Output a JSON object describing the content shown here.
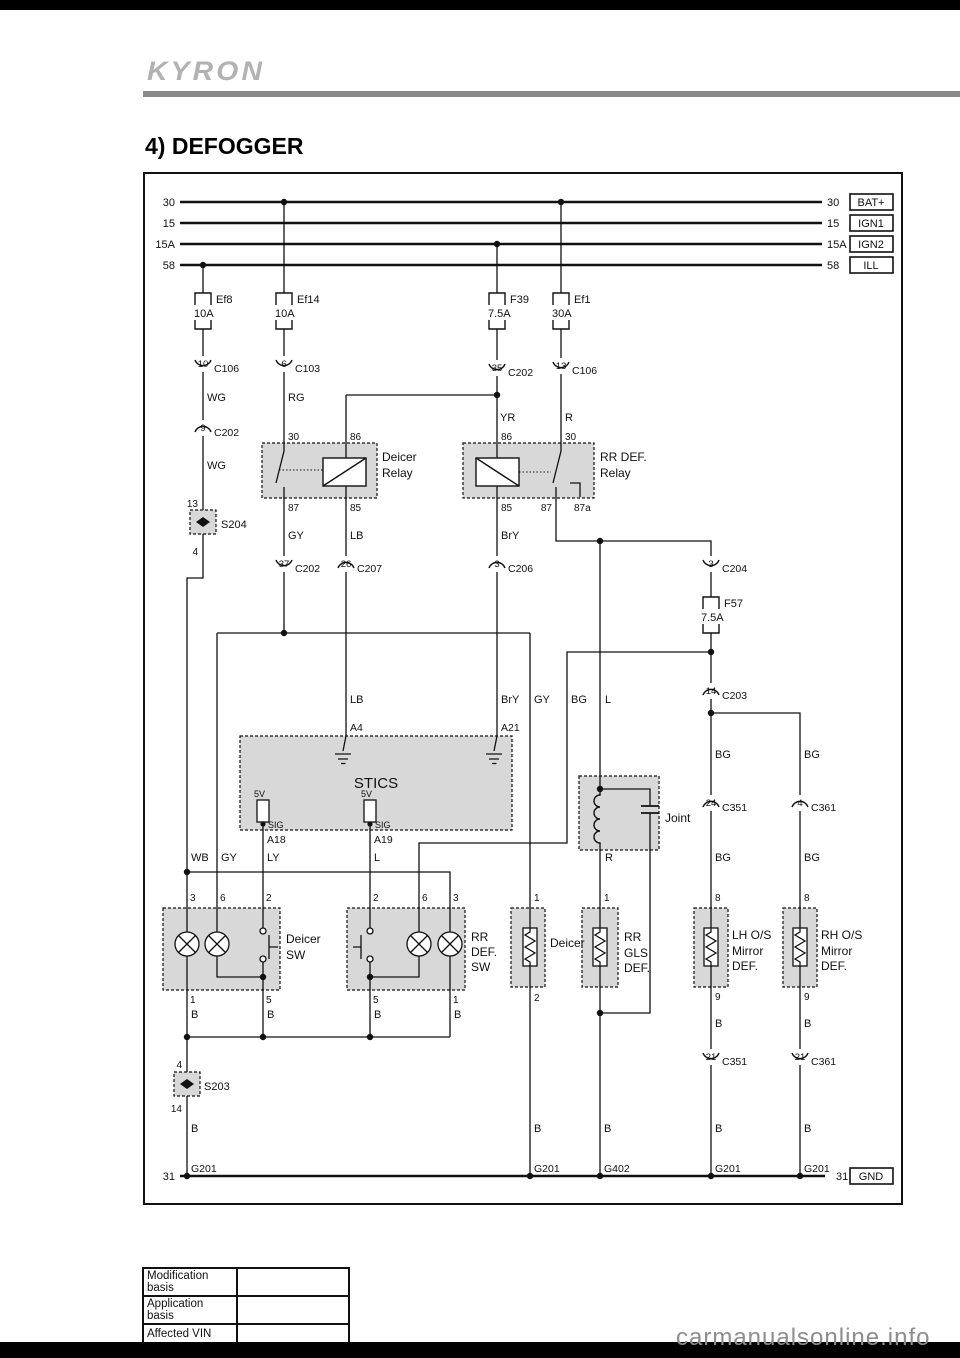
{
  "page": {
    "brand": "KYRON",
    "title": "4) DEFOGGER",
    "watermark": "carmanualsonline.info"
  },
  "footer_table": {
    "rows": [
      {
        "label": "Modification basis",
        "value": ""
      },
      {
        "label": "Application basis",
        "value": ""
      },
      {
        "label": "Affected VIN",
        "value": ""
      }
    ]
  },
  "diagram": {
    "texts": [
      {
        "n": "bus-30-left",
        "x": 175,
        "y": 206,
        "t": "30",
        "a": "end",
        "s": 11
      },
      {
        "n": "bus-15-left",
        "x": 175,
        "y": 227,
        "t": "15",
        "a": "end",
        "s": 11
      },
      {
        "n": "bus-15a-left",
        "x": 175,
        "y": 248,
        "t": "15A",
        "a": "end",
        "s": 11
      },
      {
        "n": "bus-58-left",
        "x": 175,
        "y": 269,
        "t": "58",
        "a": "end",
        "s": 11
      },
      {
        "n": "bus-30-right",
        "x": 827,
        "y": 206,
        "t": "30",
        "s": 11
      },
      {
        "n": "bus-15-right",
        "x": 827,
        "y": 227,
        "t": "15",
        "s": 11
      },
      {
        "n": "bus-15a-right",
        "x": 827,
        "y": 248,
        "t": "15A",
        "s": 11
      },
      {
        "n": "bus-58-right",
        "x": 827,
        "y": 269,
        "t": "58",
        "s": 11
      },
      {
        "n": "terminal-bat",
        "x": 871,
        "y": 206,
        "t": "BAT+",
        "a": "middle",
        "s": 11
      },
      {
        "n": "terminal-ign1",
        "x": 871,
        "y": 227,
        "t": "IGN1",
        "a": "middle",
        "s": 11
      },
      {
        "n": "terminal-ign2",
        "x": 871,
        "y": 248,
        "t": "IGN2",
        "a": "middle",
        "s": 11
      },
      {
        "n": "terminal-ill",
        "x": 871,
        "y": 269,
        "t": "ILL",
        "a": "middle",
        "s": 11
      },
      {
        "n": "bus-31-left",
        "x": 175,
        "y": 1180,
        "t": "31",
        "a": "end",
        "s": 11
      },
      {
        "n": "bus-31-right",
        "x": 836,
        "y": 1180,
        "t": "31",
        "s": 11
      },
      {
        "n": "terminal-gnd",
        "x": 871,
        "y": 1180,
        "t": "GND",
        "a": "middle",
        "s": 11
      },
      {
        "n": "fuse-ef8-name",
        "x": 216,
        "y": 303,
        "t": "Ef8",
        "s": 11
      },
      {
        "n": "fuse-ef8-amp",
        "x": 194,
        "y": 317,
        "t": "10A",
        "s": 11
      },
      {
        "n": "fuse-ef14-name",
        "x": 297,
        "y": 303,
        "t": "Ef14",
        "s": 11
      },
      {
        "n": "fuse-ef14-amp",
        "x": 275,
        "y": 317,
        "t": "10A",
        "s": 11
      },
      {
        "n": "fuse-f39-name",
        "x": 510,
        "y": 303,
        "t": "F39",
        "s": 11
      },
      {
        "n": "fuse-f39-amp",
        "x": 488,
        "y": 317,
        "t": "7.5A",
        "s": 11
      },
      {
        "n": "fuse-ef1-name",
        "x": 574,
        "y": 303,
        "t": "Ef1",
        "s": 11
      },
      {
        "n": "fuse-ef1-amp",
        "x": 552,
        "y": 317,
        "t": "30A",
        "s": 11
      },
      {
        "n": "fuse-f57-name",
        "x": 724,
        "y": 607,
        "t": "F57",
        "s": 11
      },
      {
        "n": "fuse-f57-amp",
        "x": 701,
        "y": 621,
        "t": "7.5A",
        "s": 11
      },
      {
        "n": "conn-c106-pin10",
        "x": 203,
        "y": 367,
        "t": "10",
        "a": "middle",
        "s": 9.5
      },
      {
        "n": "conn-c106-name",
        "x": 214,
        "y": 372,
        "t": "C106",
        "s": 10.5
      },
      {
        "n": "conn-c103-pin6",
        "x": 284,
        "y": 367,
        "t": "6",
        "a": "middle",
        "s": 9.5
      },
      {
        "n": "conn-c103-name",
        "x": 295,
        "y": 372,
        "t": "C103",
        "s": 10.5
      },
      {
        "n": "conn-c202-pin35",
        "x": 497,
        "y": 371,
        "t": "35",
        "a": "middle",
        "s": 9.5
      },
      {
        "n": "conn-c202-name-top",
        "x": 508,
        "y": 376,
        "t": "C202",
        "s": 10.5
      },
      {
        "n": "conn-c106-pin13",
        "x": 561,
        "y": 369,
        "t": "13",
        "a": "middle",
        "s": 9.5
      },
      {
        "n": "conn-c106b-name",
        "x": 572,
        "y": 374,
        "t": "C106",
        "s": 10.5
      },
      {
        "n": "conn-c202-pin9",
        "x": 203,
        "y": 431,
        "t": "9",
        "a": "middle",
        "s": 9.5
      },
      {
        "n": "conn-c202-name-mid",
        "x": 214,
        "y": 436,
        "t": "C202",
        "s": 10.5
      },
      {
        "n": "conn-c202-pin37",
        "x": 284,
        "y": 567,
        "t": "37",
        "a": "middle",
        "s": 9.5
      },
      {
        "n": "conn-c202-name-low",
        "x": 295,
        "y": 572,
        "t": "C202",
        "s": 10.5
      },
      {
        "n": "conn-c207-pin26",
        "x": 346,
        "y": 567,
        "t": "26",
        "a": "middle",
        "s": 9.5
      },
      {
        "n": "conn-c207-name",
        "x": 357,
        "y": 572,
        "t": "C207",
        "s": 10.5
      },
      {
        "n": "conn-c206-pin3",
        "x": 497,
        "y": 567,
        "t": "3",
        "a": "middle",
        "s": 9.5
      },
      {
        "n": "conn-c206-name",
        "x": 508,
        "y": 572,
        "t": "C206",
        "s": 10.5
      },
      {
        "n": "conn-c204-pin3",
        "x": 711,
        "y": 567,
        "t": "3",
        "a": "middle",
        "s": 9.5
      },
      {
        "n": "conn-c204-name",
        "x": 722,
        "y": 572,
        "t": "C204",
        "s": 10.5
      },
      {
        "n": "conn-c203-pin14",
        "x": 711,
        "y": 694,
        "t": "14",
        "a": "middle",
        "s": 9.5
      },
      {
        "n": "conn-c203-name",
        "x": 722,
        "y": 699,
        "t": "C203",
        "s": 10.5
      },
      {
        "n": "conn-c351-pin24",
        "x": 711,
        "y": 806,
        "t": "24",
        "a": "middle",
        "s": 9.5
      },
      {
        "n": "conn-c351-name-top",
        "x": 722,
        "y": 811,
        "t": "C351",
        "s": 10.5
      },
      {
        "n": "conn-c361-pin4",
        "x": 800,
        "y": 806,
        "t": "4",
        "a": "middle",
        "s": 9.5
      },
      {
        "n": "conn-c361-name-top",
        "x": 811,
        "y": 811,
        "t": "C361",
        "s": 10.5
      },
      {
        "n": "conn-c351-pin21",
        "x": 711,
        "y": 1060,
        "t": "21",
        "a": "middle",
        "s": 9.5
      },
      {
        "n": "conn-c351-name-low",
        "x": 722,
        "y": 1065,
        "t": "C351",
        "s": 10.5
      },
      {
        "n": "conn-c361-pin21",
        "x": 800,
        "y": 1060,
        "t": "21",
        "a": "middle",
        "s": 9.5
      },
      {
        "n": "conn-c361-name-low",
        "x": 811,
        "y": 1065,
        "t": "C361",
        "s": 10.5
      },
      {
        "n": "wire-wg-1",
        "x": 207,
        "y": 401,
        "t": "WG",
        "s": 11
      },
      {
        "n": "wire-rg",
        "x": 288,
        "y": 401,
        "t": "RG",
        "s": 11
      },
      {
        "n": "wire-yr",
        "x": 500,
        "y": 421,
        "t": "YR",
        "s": 11
      },
      {
        "n": "wire-r-top",
        "x": 565,
        "y": 421,
        "t": "R",
        "s": 11
      },
      {
        "n": "wire-wg-2",
        "x": 207,
        "y": 469,
        "t": "WG",
        "s": 11
      },
      {
        "n": "wire-gy-1",
        "x": 288,
        "y": 539,
        "t": "GY",
        "s": 11
      },
      {
        "n": "wire-lb-1",
        "x": 350,
        "y": 539,
        "t": "LB",
        "s": 11
      },
      {
        "n": "wire-bry-1",
        "x": 501,
        "y": 539,
        "t": "BrY",
        "s": 11
      },
      {
        "n": "wire-lb-2",
        "x": 350,
        "y": 703,
        "t": "LB",
        "s": 11
      },
      {
        "n": "wire-bry-2",
        "x": 501,
        "y": 703,
        "t": "BrY",
        "s": 11
      },
      {
        "n": "wire-gy-2",
        "x": 534,
        "y": 703,
        "t": "GY",
        "s": 11
      },
      {
        "n": "wire-bg-1",
        "x": 571,
        "y": 703,
        "t": "BG",
        "s": 11
      },
      {
        "n": "wire-l-1",
        "x": 605,
        "y": 703,
        "t": "L",
        "s": 11
      },
      {
        "n": "wire-wb",
        "x": 191,
        "y": 861,
        "t": "WB",
        "s": 11
      },
      {
        "n": "wire-gy-3",
        "x": 221,
        "y": 861,
        "t": "GY",
        "s": 11
      },
      {
        "n": "wire-ly",
        "x": 267,
        "y": 861,
        "t": "LY",
        "s": 11
      },
      {
        "n": "wire-l-2",
        "x": 374,
        "y": 861,
        "t": "L",
        "s": 11
      },
      {
        "n": "wire-r-joint",
        "x": 605,
        "y": 861,
        "t": "R",
        "s": 11
      },
      {
        "n": "wire-bg-lh-1",
        "x": 715,
        "y": 758,
        "t": "BG",
        "s": 11
      },
      {
        "n": "wire-bg-rh-1",
        "x": 804,
        "y": 758,
        "t": "BG",
        "s": 11
      },
      {
        "n": "wire-bg-lh-2",
        "x": 715,
        "y": 861,
        "t": "BG",
        "s": 11
      },
      {
        "n": "wire-bg-rh-2",
        "x": 804,
        "y": 861,
        "t": "BG",
        "s": 11
      },
      {
        "n": "wire-b-sw1",
        "x": 191,
        "y": 1018,
        "t": "B",
        "s": 11
      },
      {
        "n": "wire-b-sw2",
        "x": 267,
        "y": 1018,
        "t": "B",
        "s": 11
      },
      {
        "n": "wire-b-sw3",
        "x": 374,
        "y": 1018,
        "t": "B",
        "s": 11
      },
      {
        "n": "wire-b-sw4",
        "x": 454,
        "y": 1018,
        "t": "B",
        "s": 11
      },
      {
        "n": "wire-b-lh-1",
        "x": 715,
        "y": 1027,
        "t": "B",
        "s": 11
      },
      {
        "n": "wire-b-rh-1",
        "x": 804,
        "y": 1027,
        "t": "B",
        "s": 11
      },
      {
        "n": "wire-b-left",
        "x": 191,
        "y": 1132,
        "t": "B",
        "s": 11
      },
      {
        "n": "wire-b-deicer",
        "x": 534,
        "y": 1132,
        "t": "B",
        "s": 11
      },
      {
        "n": "wire-b-gls",
        "x": 604,
        "y": 1132,
        "t": "B",
        "s": 11
      },
      {
        "n": "wire-b-lh-2",
        "x": 715,
        "y": 1132,
        "t": "B",
        "s": 11
      },
      {
        "n": "wire-b-rh-2",
        "x": 804,
        "y": 1132,
        "t": "B",
        "s": 11
      },
      {
        "n": "splice-s204-pin13",
        "x": 198,
        "y": 507,
        "t": "13",
        "a": "end",
        "s": 10
      },
      {
        "n": "splice-s204-pin4",
        "x": 198,
        "y": 555,
        "t": "4",
        "a": "end",
        "s": 10
      },
      {
        "n": "relay-deicer-pin30",
        "x": 288,
        "y": 440,
        "t": "30",
        "s": 10
      },
      {
        "n": "relay-deicer-pin86",
        "x": 350,
        "y": 440,
        "t": "86",
        "s": 10
      },
      {
        "n": "relay-rrdef-pin86",
        "x": 501,
        "y": 440,
        "t": "86",
        "s": 10
      },
      {
        "n": "relay-rrdef-pin30",
        "x": 565,
        "y": 440,
        "t": "30",
        "s": 10
      },
      {
        "n": "relay-deicer-pin87",
        "x": 288,
        "y": 511,
        "t": "87",
        "s": 10
      },
      {
        "n": "relay-deicer-pin85",
        "x": 350,
        "y": 511,
        "t": "85",
        "s": 10
      },
      {
        "n": "relay-rrdef-pin85",
        "x": 501,
        "y": 511,
        "t": "85",
        "s": 10
      },
      {
        "n": "relay-rrdef-pin87",
        "x": 552,
        "y": 511,
        "t": "87",
        "a": "end",
        "s": 10
      },
      {
        "n": "relay-rrdef-pin87a",
        "x": 574,
        "y": 511,
        "t": "87a",
        "s": 10
      },
      {
        "n": "stics-pin-a4",
        "x": 350,
        "y": 731,
        "t": "A4",
        "s": 10.5
      },
      {
        "n": "stics-pin-a21",
        "x": 501,
        "y": 731,
        "t": "A21",
        "s": 10.5
      },
      {
        "n": "stics-5v-1",
        "x": 254,
        "y": 797,
        "t": "5V",
        "s": 9
      },
      {
        "n": "stics-sig-1",
        "x": 268,
        "y": 828,
        "t": "SIG",
        "s": 9
      },
      {
        "n": "stics-5v-2",
        "x": 361,
        "y": 797,
        "t": "5V",
        "s": 9
      },
      {
        "n": "stics-sig-2",
        "x": 375,
        "y": 828,
        "t": "SIG",
        "s": 9
      },
      {
        "n": "stics-pin-a18",
        "x": 267,
        "y": 843,
        "t": "A18",
        "s": 10.5
      },
      {
        "n": "stics-pin-a19",
        "x": 374,
        "y": 843,
        "t": "A19",
        "s": 10.5
      },
      {
        "n": "deicersw-pin3",
        "x": 190,
        "y": 901,
        "t": "3",
        "s": 10
      },
      {
        "n": "deicersw-pin6",
        "x": 220,
        "y": 901,
        "t": "6",
        "s": 10
      },
      {
        "n": "deicersw-pin2",
        "x": 266,
        "y": 901,
        "t": "2",
        "s": 10
      },
      {
        "n": "rrdefsw-pin2",
        "x": 373,
        "y": 901,
        "t": "2",
        "s": 10
      },
      {
        "n": "rrdefsw-pin6",
        "x": 422,
        "y": 901,
        "t": "6",
        "s": 10
      },
      {
        "n": "rrdefsw-pin3",
        "x": 453,
        "y": 901,
        "t": "3",
        "s": 10
      },
      {
        "n": "deicer-el-pin1",
        "x": 534,
        "y": 901,
        "t": "1",
        "s": 10
      },
      {
        "n": "rrgls-pin1",
        "x": 604,
        "y": 901,
        "t": "1",
        "s": 10
      },
      {
        "n": "lhmirror-pin8",
        "x": 715,
        "y": 901,
        "t": "8",
        "s": 10
      },
      {
        "n": "rhmirror-pin8",
        "x": 804,
        "y": 901,
        "t": "8",
        "s": 10
      },
      {
        "n": "deicersw-pin1",
        "x": 190,
        "y": 1003,
        "t": "1",
        "s": 10
      },
      {
        "n": "deicersw-pin5",
        "x": 266,
        "y": 1003,
        "t": "5",
        "s": 10
      },
      {
        "n": "rrdefsw-pin5",
        "x": 373,
        "y": 1003,
        "t": "5",
        "s": 10
      },
      {
        "n": "rrdefsw-pin1",
        "x": 453,
        "y": 1003,
        "t": "1",
        "s": 10
      },
      {
        "n": "deicer-el-pin2",
        "x": 534,
        "y": 1001,
        "t": "2",
        "s": 10
      },
      {
        "n": "lhmirror-pin9",
        "x": 715,
        "y": 1000,
        "t": "9",
        "s": 10
      },
      {
        "n": "rhmirror-pin9",
        "x": 804,
        "y": 1000,
        "t": "9",
        "s": 10
      },
      {
        "n": "splice-s203-pin4",
        "x": 182,
        "y": 1068,
        "t": "4",
        "a": "end",
        "s": 10
      },
      {
        "n": "splice-s203-pin14",
        "x": 182,
        "y": 1112,
        "t": "14",
        "a": "end",
        "s": 10
      },
      {
        "n": "relay-deicer-label1",
        "x": 382,
        "y": 461,
        "t": "Deicer",
        "s": 12
      },
      {
        "n": "relay-deicer-label2",
        "x": 382,
        "y": 477,
        "t": "Relay",
        "s": 12
      },
      {
        "n": "relay-rrdef-label1",
        "x": 600,
        "y": 461,
        "t": "RR DEF.",
        "s": 12
      },
      {
        "n": "relay-rrdef-label2",
        "x": 600,
        "y": 477,
        "t": "Relay",
        "s": 12
      },
      {
        "n": "stics-label",
        "x": 376,
        "y": 788,
        "t": "STICS",
        "a": "middle",
        "s": 15
      },
      {
        "n": "joint-label",
        "x": 665,
        "y": 822,
        "t": "Joint",
        "s": 12
      },
      {
        "n": "deicersw-label1",
        "x": 286,
        "y": 943,
        "t": "Deicer",
        "s": 12
      },
      {
        "n": "deicersw-label2",
        "x": 286,
        "y": 959,
        "t": "SW",
        "s": 12
      },
      {
        "n": "rrdefsw-label1",
        "x": 471,
        "y": 941,
        "t": "RR",
        "s": 12
      },
      {
        "n": "rrdefsw-label2",
        "x": 471,
        "y": 956,
        "t": "DEF.",
        "s": 12
      },
      {
        "n": "rrdefsw-label3",
        "x": 471,
        "y": 971,
        "t": "SW",
        "s": 12
      },
      {
        "n": "deicer-el-label",
        "x": 550,
        "y": 947,
        "t": "Deicer",
        "s": 12
      },
      {
        "n": "rrgls-label1",
        "x": 624,
        "y": 941,
        "t": "RR",
        "s": 12
      },
      {
        "n": "rrgls-label2",
        "x": 624,
        "y": 957,
        "t": "GLS",
        "s": 12
      },
      {
        "n": "rrgls-label3",
        "x": 624,
        "y": 972,
        "t": "DEF.",
        "s": 12
      },
      {
        "n": "lhmirror-label1",
        "x": 732,
        "y": 939,
        "t": "LH O/S",
        "s": 12
      },
      {
        "n": "lhmirror-label2",
        "x": 732,
        "y": 955,
        "t": "Mirror",
        "s": 12
      },
      {
        "n": "lhmirror-label3",
        "x": 732,
        "y": 970,
        "t": "DEF.",
        "s": 12
      },
      {
        "n": "rhmirror-label1",
        "x": 821,
        "y": 939,
        "t": "RH O/S",
        "s": 12
      },
      {
        "n": "rhmirror-label2",
        "x": 821,
        "y": 955,
        "t": "Mirror",
        "s": 12
      },
      {
        "n": "rhmirror-label3",
        "x": 821,
        "y": 970,
        "t": "DEF.",
        "s": 12
      },
      {
        "n": "splice-s204-label",
        "x": 221,
        "y": 528,
        "t": "S204",
        "s": 11
      },
      {
        "n": "splice-s203-label",
        "x": 204,
        "y": 1090,
        "t": "S203",
        "s": 11
      },
      {
        "n": "ground-g201-1",
        "x": 191,
        "y": 1172,
        "t": "G201",
        "s": 10.5
      },
      {
        "n": "ground-g201-2",
        "x": 534,
        "y": 1172,
        "t": "G201",
        "s": 10.5
      },
      {
        "n": "ground-g402",
        "x": 604,
        "y": 1172,
        "t": "G402",
        "s": 10.5
      },
      {
        "n": "ground-g201-3",
        "x": 715,
        "y": 1172,
        "t": "G201",
        "s": 10.5
      },
      {
        "n": "ground-g201-4",
        "x": 804,
        "y": 1172,
        "t": "G201",
        "s": 10.5
      }
    ]
  }
}
